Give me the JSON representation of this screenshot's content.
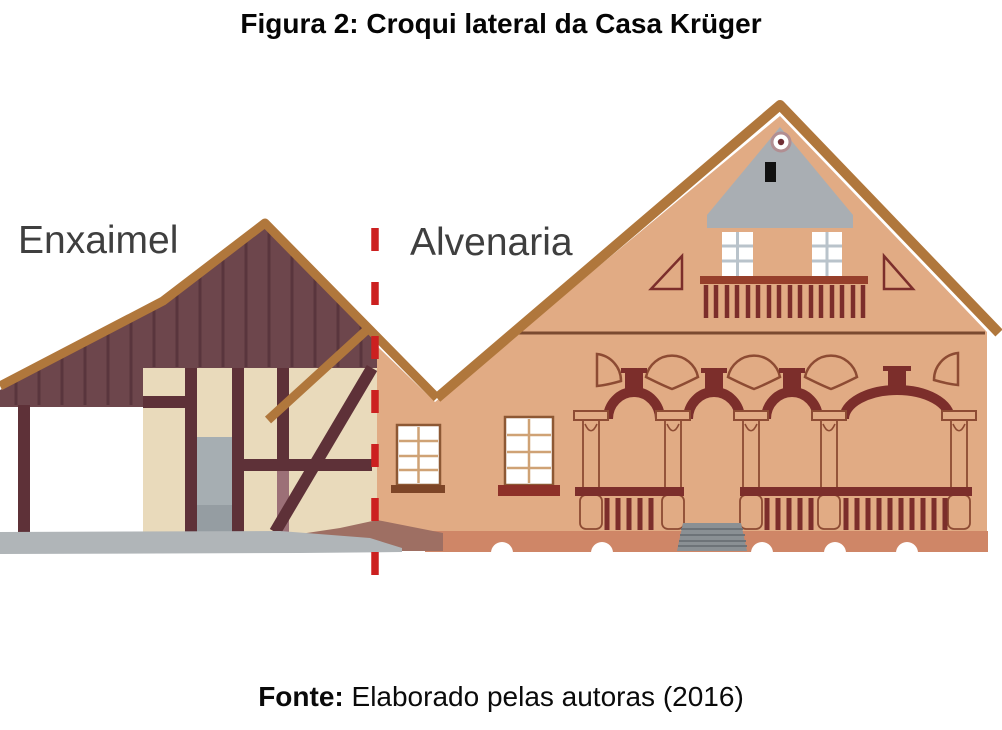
{
  "figure": {
    "title": "Figura 2: Croqui lateral da Casa Krüger",
    "source_label": "Fonte:",
    "source_text": "Elaborado pelas autoras (2016)"
  },
  "diagram": {
    "left_label": "Enxaimel",
    "right_label": "Alvenaria"
  },
  "colors": {
    "left_roof": "#6d464c",
    "roof_plank_line": "#59353d",
    "roof_trim": "#b0773c",
    "timber": "#5e3138",
    "left_wall_cream": "#e9dabb",
    "door_gray": "#a6aeb2",
    "ground_gray": "#b0b5b8",
    "right_wall_salmon": "#e1ab84",
    "foundation": "#cf8667",
    "foundation_shadow": "#9e6f63",
    "gable_gray": "#a9aeb3",
    "arch_maroon": "#7c2e2b",
    "detail_outline": "#8d4b33",
    "balcony_rail": "#963f2b",
    "steps_gray": "#8a9094",
    "divider_red": "#cc2020",
    "label_text": "#3f3f3f",
    "title_text": "#050505"
  }
}
